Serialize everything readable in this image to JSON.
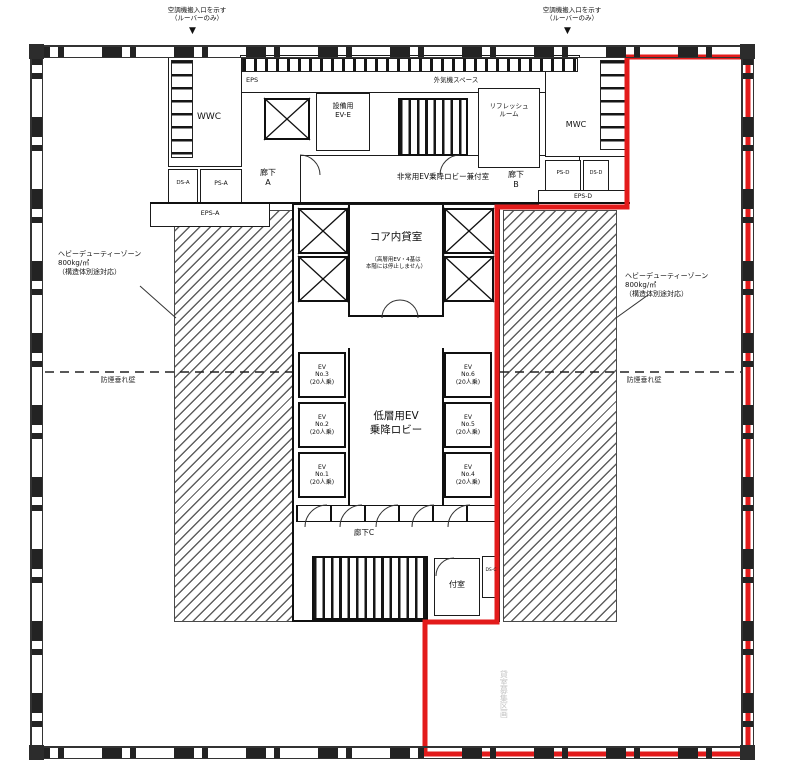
{
  "colors": {
    "red_zone": "#e31b1b",
    "line": "#1b1b1b",
    "hatch": "#5f5f5f"
  },
  "notes": {
    "supply_left": "空調機搬入口を示す\n（ルーバーのみ）",
    "supply_left_arrow": "▼",
    "supply_right": "空調機搬入口を示す\n（ルーバーのみ）",
    "supply_right_arrow": "▼",
    "heavy_left": "ヘビーデューティーゾーン\n800kg/㎡\n（構造体別途対応）",
    "heavy_right": "ヘビーデューティーゾーン\n800kg/㎡\n（構造体別途対応）",
    "smoke_left": "防煙垂れ壁",
    "smoke_right": "防煙垂れ壁",
    "vertical_faint": "貸室募集区画"
  },
  "rooms": {
    "wwc": "WWC",
    "mwc": "MWC",
    "refresh": "リフレッシュ\nルーム",
    "eps": "EPS",
    "outdoor_air": "外気機スペース",
    "ds_a": "DS-A",
    "ps_a": "PS-A",
    "eps_a": "EPS-A",
    "corridor_a": "廊下\nA",
    "corridor_b": "廊下\nB",
    "corridor_c": "廊下C",
    "equip_ev": "設備用\nEV-E",
    "emergency_ev_lobby": "非常用EV乗降ロビー兼付室",
    "core_rental": "コア内貸室",
    "core_rental_note": "（高層用EV・4基は\n本階には停止しません）",
    "low_ev_lobby": "低層用EV\n乗降ロビー",
    "anteroom": "付室",
    "ps_d": "PS-D",
    "ds_d": "DS-D",
    "eps_d": "EPS-D",
    "ds_c": "DS-C"
  },
  "elevators": {
    "left": [
      "EV\nNo.3\n(20人乗)",
      "EV\nNo.2\n(20人乗)",
      "EV\nNo.1\n(20人乗)"
    ],
    "right": [
      "EV\nNo.6\n(20人乗)",
      "EV\nNo.5\n(20人乗)",
      "EV\nNo.4\n(20人乗)"
    ]
  }
}
